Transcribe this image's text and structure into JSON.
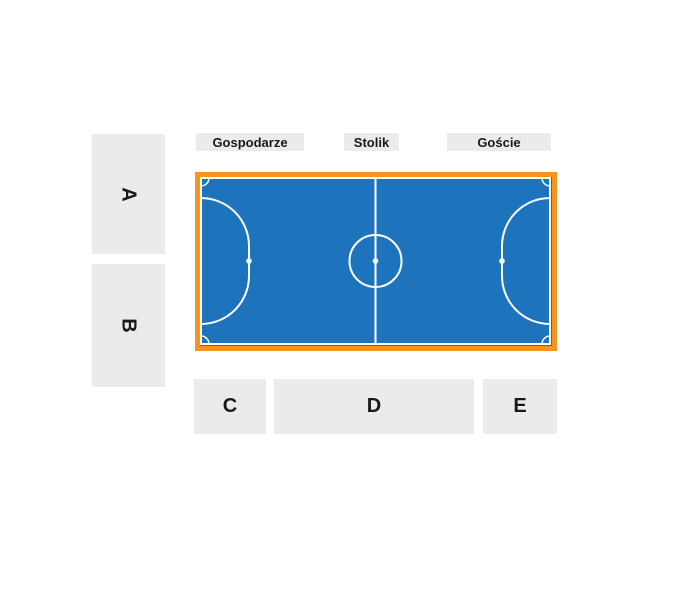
{
  "colors": {
    "court_blue": "#1e74bc",
    "court_border_orange": "#f6941e",
    "court_line_white": "#ffffff",
    "section_background": "#ebebeb",
    "text_dark": "#1a1a1a",
    "page_background": "#ffffff"
  },
  "top_labels": {
    "hosts": {
      "label": "Gospodarze"
    },
    "table": {
      "label": "Stolik"
    },
    "guests": {
      "label": "Goście"
    }
  },
  "side_sections": {
    "a": {
      "label": "A"
    },
    "b": {
      "label": "B"
    }
  },
  "bottom_sections": {
    "c": {
      "label": "C"
    },
    "d": {
      "label": "D"
    },
    "e": {
      "label": "E"
    }
  }
}
